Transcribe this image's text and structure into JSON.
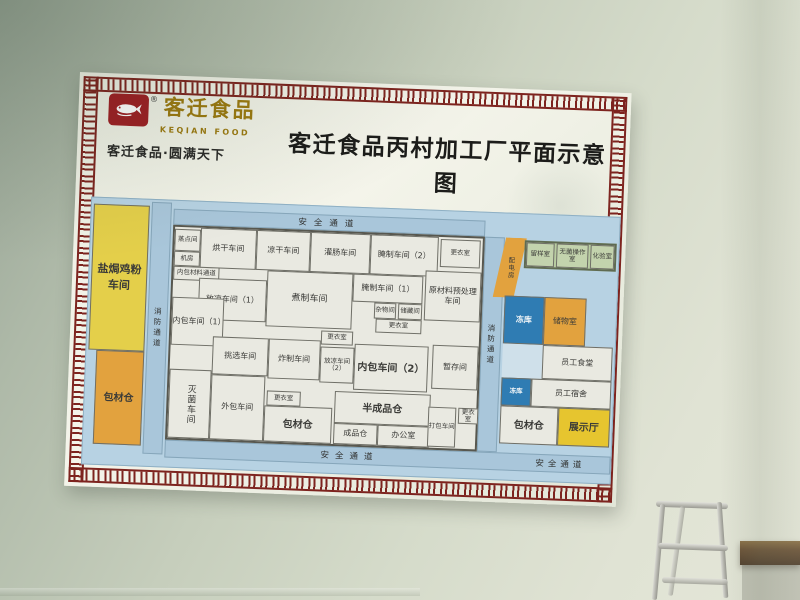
{
  "sign": {
    "logo": {
      "brand_zh": "客迁食品",
      "brand_en": "KEQIAN FOOD",
      "registered_mark": "®",
      "tagline": "客迁食品·圆满天下",
      "icon": "fish-icon"
    },
    "title": "客迁食品丙村加工厂平面示意图"
  },
  "plan": {
    "corridors": {
      "top": "安全通道",
      "bottom": "安全通道",
      "bottom_right": "安全通道",
      "left_vertical": "消防通道",
      "right_vertical": "消防通道"
    },
    "rooms": [
      {
        "label": "盐焗鸡粉车间"
      },
      {
        "label": "包材仓"
      },
      {
        "label": "蒸点间"
      },
      {
        "label": "机房"
      },
      {
        "label": "内包材料通道"
      },
      {
        "label": "烘干车间"
      },
      {
        "label": "凉干车间"
      },
      {
        "label": "灌肠车间"
      },
      {
        "label": "腌制车间（2）"
      },
      {
        "label": "更衣室"
      },
      {
        "label": "原材料预处理车间"
      },
      {
        "label": "放凉车间（1）"
      },
      {
        "label": "煮制车间"
      },
      {
        "label": "腌制车间（1）"
      },
      {
        "label": "杂物间"
      },
      {
        "label": "储藏间"
      },
      {
        "label": "更衣室"
      },
      {
        "label": "内包车间（1）"
      },
      {
        "label": "挑选车间"
      },
      {
        "label": "更衣室"
      },
      {
        "label": "炸制车间"
      },
      {
        "label": "放凉车间（2）"
      },
      {
        "label": "内包车间（2）"
      },
      {
        "label": "暂存间"
      },
      {
        "label": "灭菌车间"
      },
      {
        "label": "外包车间"
      },
      {
        "label": "更衣室"
      },
      {
        "label": "包材仓"
      },
      {
        "label": "半成品仓"
      },
      {
        "label": "成品仓"
      },
      {
        "label": "办公室"
      },
      {
        "label": "打包车间"
      },
      {
        "label": "更衣室"
      },
      {
        "label": "配电房"
      },
      {
        "label": "留样室"
      },
      {
        "label": "无菌操作室"
      },
      {
        "label": "化验室"
      },
      {
        "label": "冻库"
      },
      {
        "label": "储物室"
      },
      {
        "label": "员工食堂"
      },
      {
        "label": "冻库"
      },
      {
        "label": "员工宿舍"
      },
      {
        "label": "包材仓"
      },
      {
        "label": "展示厅"
      }
    ]
  },
  "colors": {
    "border_red": "#7d231e",
    "logo_red": "#9e1f24",
    "brand_gold": "#9c7a10",
    "plan_blue": "#b7d2e3",
    "corridor_blue": "#a9c6da",
    "room_fill": "#e9e9e1",
    "workshop_yellow": "#e4cf4a",
    "warehouse_orange": "#e2a23e",
    "freezer_blue": "#2f7cb3",
    "lab_green": "#b9cda2",
    "showroom_yellow": "#e6c52f"
  }
}
